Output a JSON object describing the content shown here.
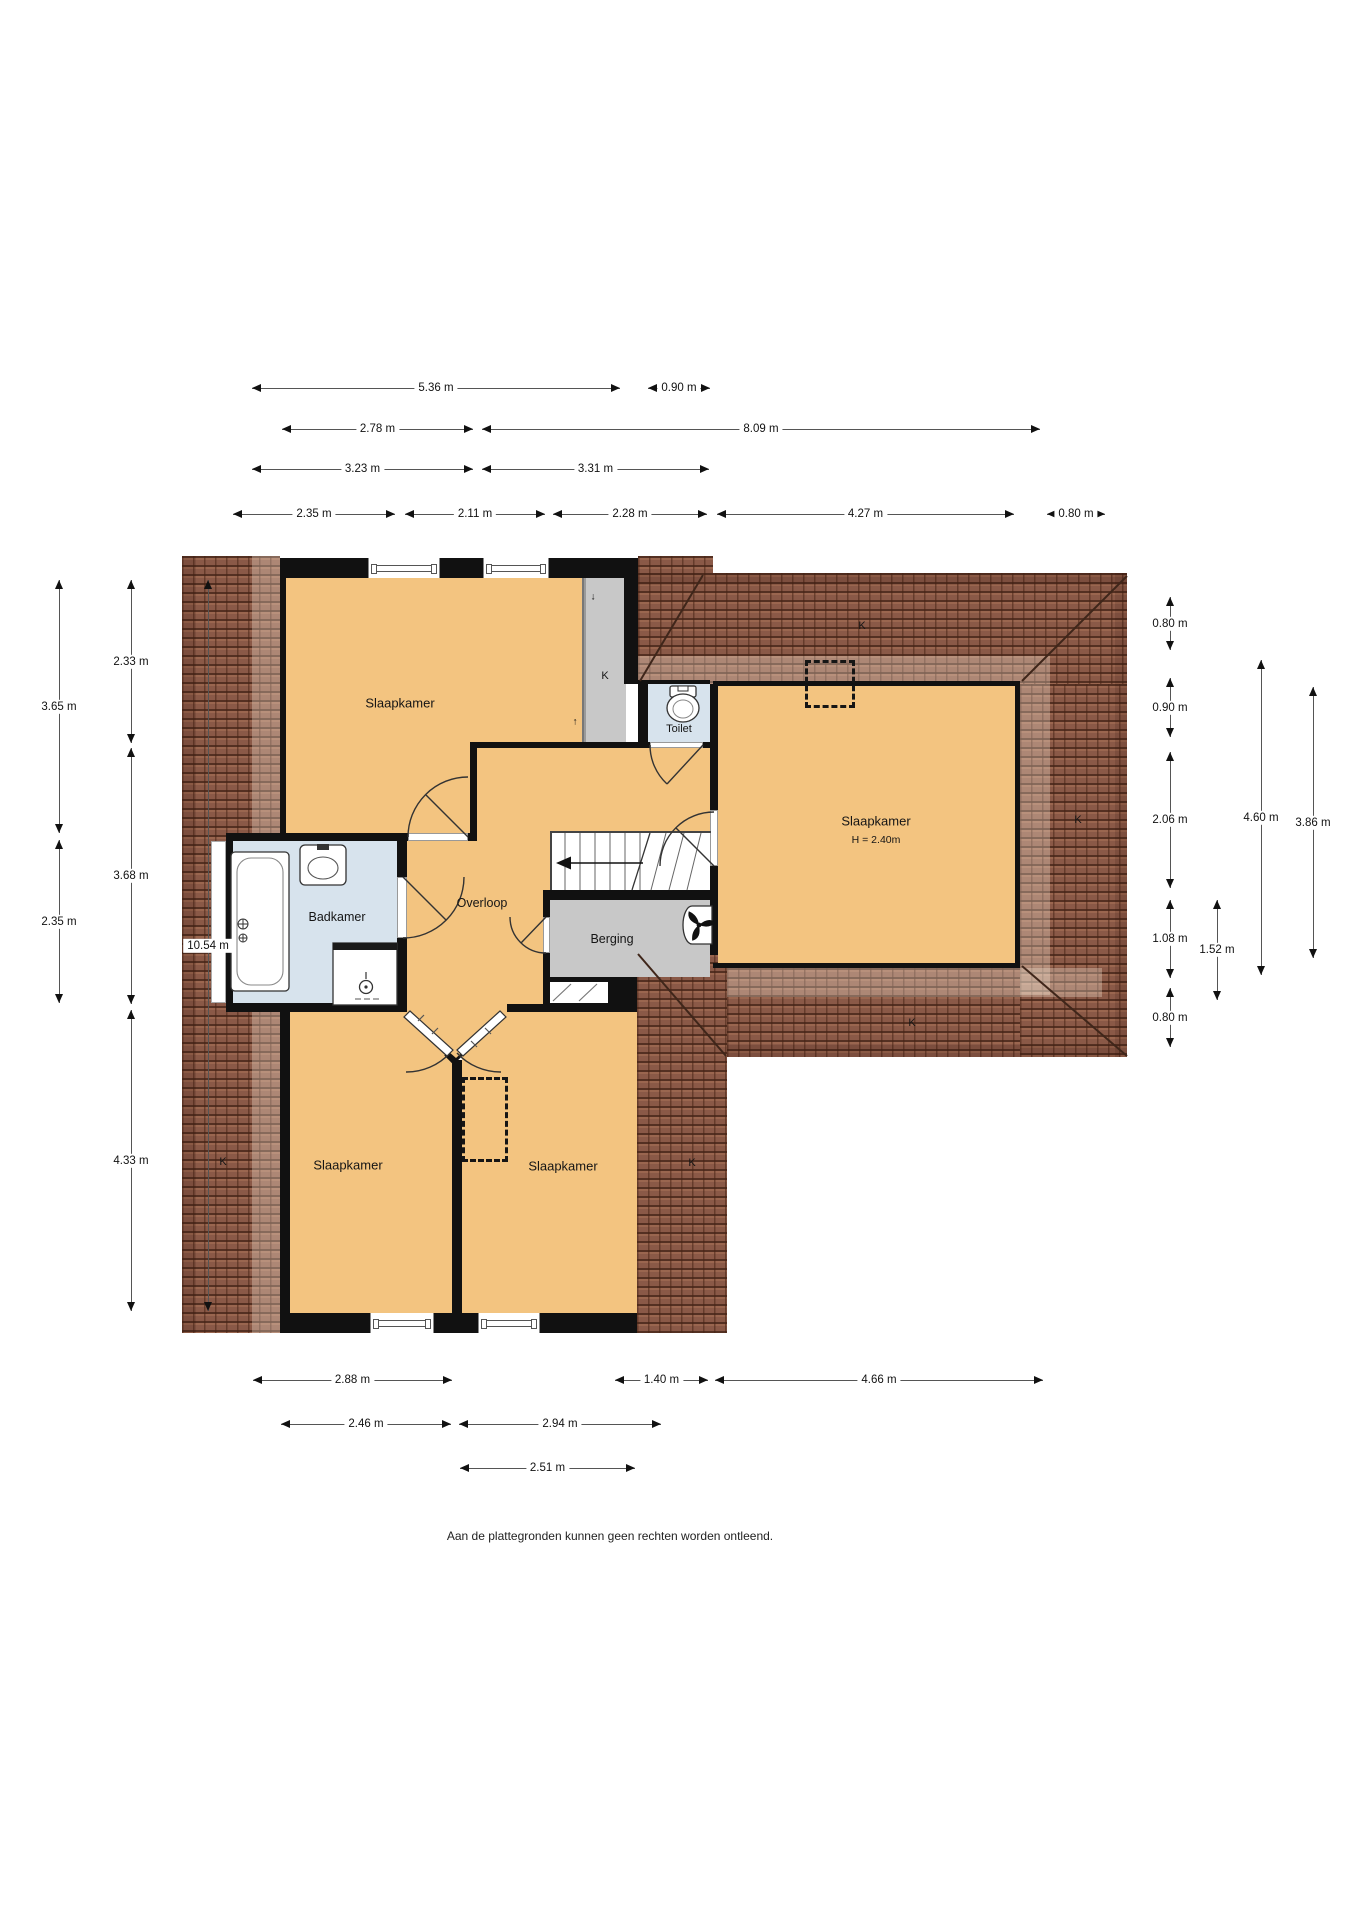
{
  "floorplan": {
    "disclaimer": "Aan de plattegronden kunnen geen rechten worden ontleend.",
    "rooms": [
      {
        "id": "slaapkamer-nw",
        "label": "Slaapkamer",
        "x": 400,
        "y": 703,
        "fs": 13
      },
      {
        "id": "slaapkamer-e",
        "label": "Slaapkamer",
        "x": 876,
        "y": 821,
        "fs": 13
      },
      {
        "id": "slaapkamer-e-height",
        "label": "H = 2.40m",
        "x": 876,
        "y": 840,
        "fs": 10.5
      },
      {
        "id": "slaapkamer-sw",
        "label": "Slaapkamer",
        "x": 348,
        "y": 1165,
        "fs": 13
      },
      {
        "id": "slaapkamer-se",
        "label": "Slaapkamer",
        "x": 563,
        "y": 1166,
        "fs": 13
      },
      {
        "id": "badkamer",
        "label": "Badkamer",
        "x": 337,
        "y": 917,
        "fs": 12.5
      },
      {
        "id": "overloop",
        "label": "Overloop",
        "x": 482,
        "y": 903,
        "fs": 12.5
      },
      {
        "id": "berging",
        "label": "Berging",
        "x": 612,
        "y": 939,
        "fs": 12.5
      },
      {
        "id": "toilet",
        "label": "Toilet",
        "x": 679,
        "y": 729,
        "fs": 11
      }
    ],
    "roof_marks": [
      {
        "id": "k-left-strip",
        "label": "K",
        "x": 223,
        "y": 1162
      },
      {
        "id": "k-closet",
        "label": "K",
        "x": 605,
        "y": 676
      },
      {
        "id": "k-bottom-center",
        "label": "K",
        "x": 692,
        "y": 1163
      },
      {
        "id": "k-wing-top",
        "label": "K",
        "x": 862,
        "y": 626
      },
      {
        "id": "k-wing-right",
        "label": "K",
        "x": 1078,
        "y": 820
      },
      {
        "id": "k-wing-bottom",
        "label": "K",
        "x": 912,
        "y": 1023
      }
    ],
    "small_arrows": [
      {
        "id": "closet-arrow-down",
        "label": "↓",
        "x": 593,
        "y": 597
      },
      {
        "id": "closet-arrow-up",
        "label": "↑",
        "x": 575,
        "y": 722
      }
    ],
    "dimensions": {
      "top": [
        {
          "label": "5.36 m",
          "y": 388,
          "x1": 252,
          "x2": 620
        },
        {
          "label": "0.90 m",
          "y": 388,
          "x1": 648,
          "x2": 710
        },
        {
          "label": "2.78 m",
          "y": 429,
          "x1": 282,
          "x2": 473
        },
        {
          "label": "8.09 m",
          "y": 429,
          "x1": 482,
          "x2": 1040
        },
        {
          "label": "3.23 m",
          "y": 469,
          "x1": 252,
          "x2": 473
        },
        {
          "label": "3.31 m",
          "y": 469,
          "x1": 482,
          "x2": 709
        },
        {
          "label": "2.35 m",
          "y": 514,
          "x1": 233,
          "x2": 395
        },
        {
          "label": "2.11 m",
          "y": 514,
          "x1": 405,
          "x2": 545
        },
        {
          "label": "2.28 m",
          "y": 514,
          "x1": 553,
          "x2": 707
        },
        {
          "label": "4.27 m",
          "y": 514,
          "x1": 717,
          "x2": 1014
        },
        {
          "label": "0.80 m",
          "y": 514,
          "x1": 1047,
          "x2": 1105
        }
      ],
      "left": [
        {
          "label": "3.65 m",
          "x": 59,
          "y1": 580,
          "y2": 833
        },
        {
          "label": "2.35 m",
          "x": 59,
          "y1": 840,
          "y2": 1003
        },
        {
          "label": "2.33 m",
          "x": 131,
          "y1": 580,
          "y2": 743
        },
        {
          "label": "3.68 m",
          "x": 131,
          "y1": 748,
          "y2": 1004
        },
        {
          "label": "4.33 m",
          "x": 131,
          "y1": 1010,
          "y2": 1311
        },
        {
          "label": "10.54 m",
          "x": 208,
          "y1": 580,
          "y2": 1311
        }
      ],
      "right": [
        {
          "label": "0.80 m",
          "x": 1170,
          "y1": 597,
          "y2": 650
        },
        {
          "label": "0.90 m",
          "x": 1170,
          "y1": 678,
          "y2": 737
        },
        {
          "label": "2.06 m",
          "x": 1170,
          "y1": 752,
          "y2": 888
        },
        {
          "label": "1.08 m",
          "x": 1170,
          "y1": 900,
          "y2": 978
        },
        {
          "label": "0.80 m",
          "x": 1170,
          "y1": 988,
          "y2": 1047
        },
        {
          "label": "1.52 m",
          "x": 1217,
          "y1": 900,
          "y2": 1000
        },
        {
          "label": "4.60 m",
          "x": 1261,
          "y1": 660,
          "y2": 975
        },
        {
          "label": "3.86 m",
          "x": 1313,
          "y1": 687,
          "y2": 958
        }
      ],
      "bottom": [
        {
          "label": "2.88 m",
          "y": 1380,
          "x1": 253,
          "x2": 452
        },
        {
          "label": "1.40 m",
          "y": 1380,
          "x1": 615,
          "x2": 708
        },
        {
          "label": "4.66 m",
          "y": 1380,
          "x1": 715,
          "x2": 1043
        },
        {
          "label": "2.46 m",
          "y": 1424,
          "x1": 281,
          "x2": 451
        },
        {
          "label": "2.94 m",
          "y": 1424,
          "x1": 459,
          "x2": 661
        },
        {
          "label": "2.51 m",
          "y": 1468,
          "x1": 460,
          "x2": 635
        }
      ]
    },
    "disclaimer_pos": {
      "x": 610,
      "y": 1536
    },
    "colors": {
      "floor": "#f3c480",
      "closet_gray": "#c8c8c8",
      "bath_blue": "#d7e3ed",
      "wall": "#111111",
      "roof": "#8a5947",
      "dim_line": "#555555",
      "text": "#151515"
    }
  }
}
